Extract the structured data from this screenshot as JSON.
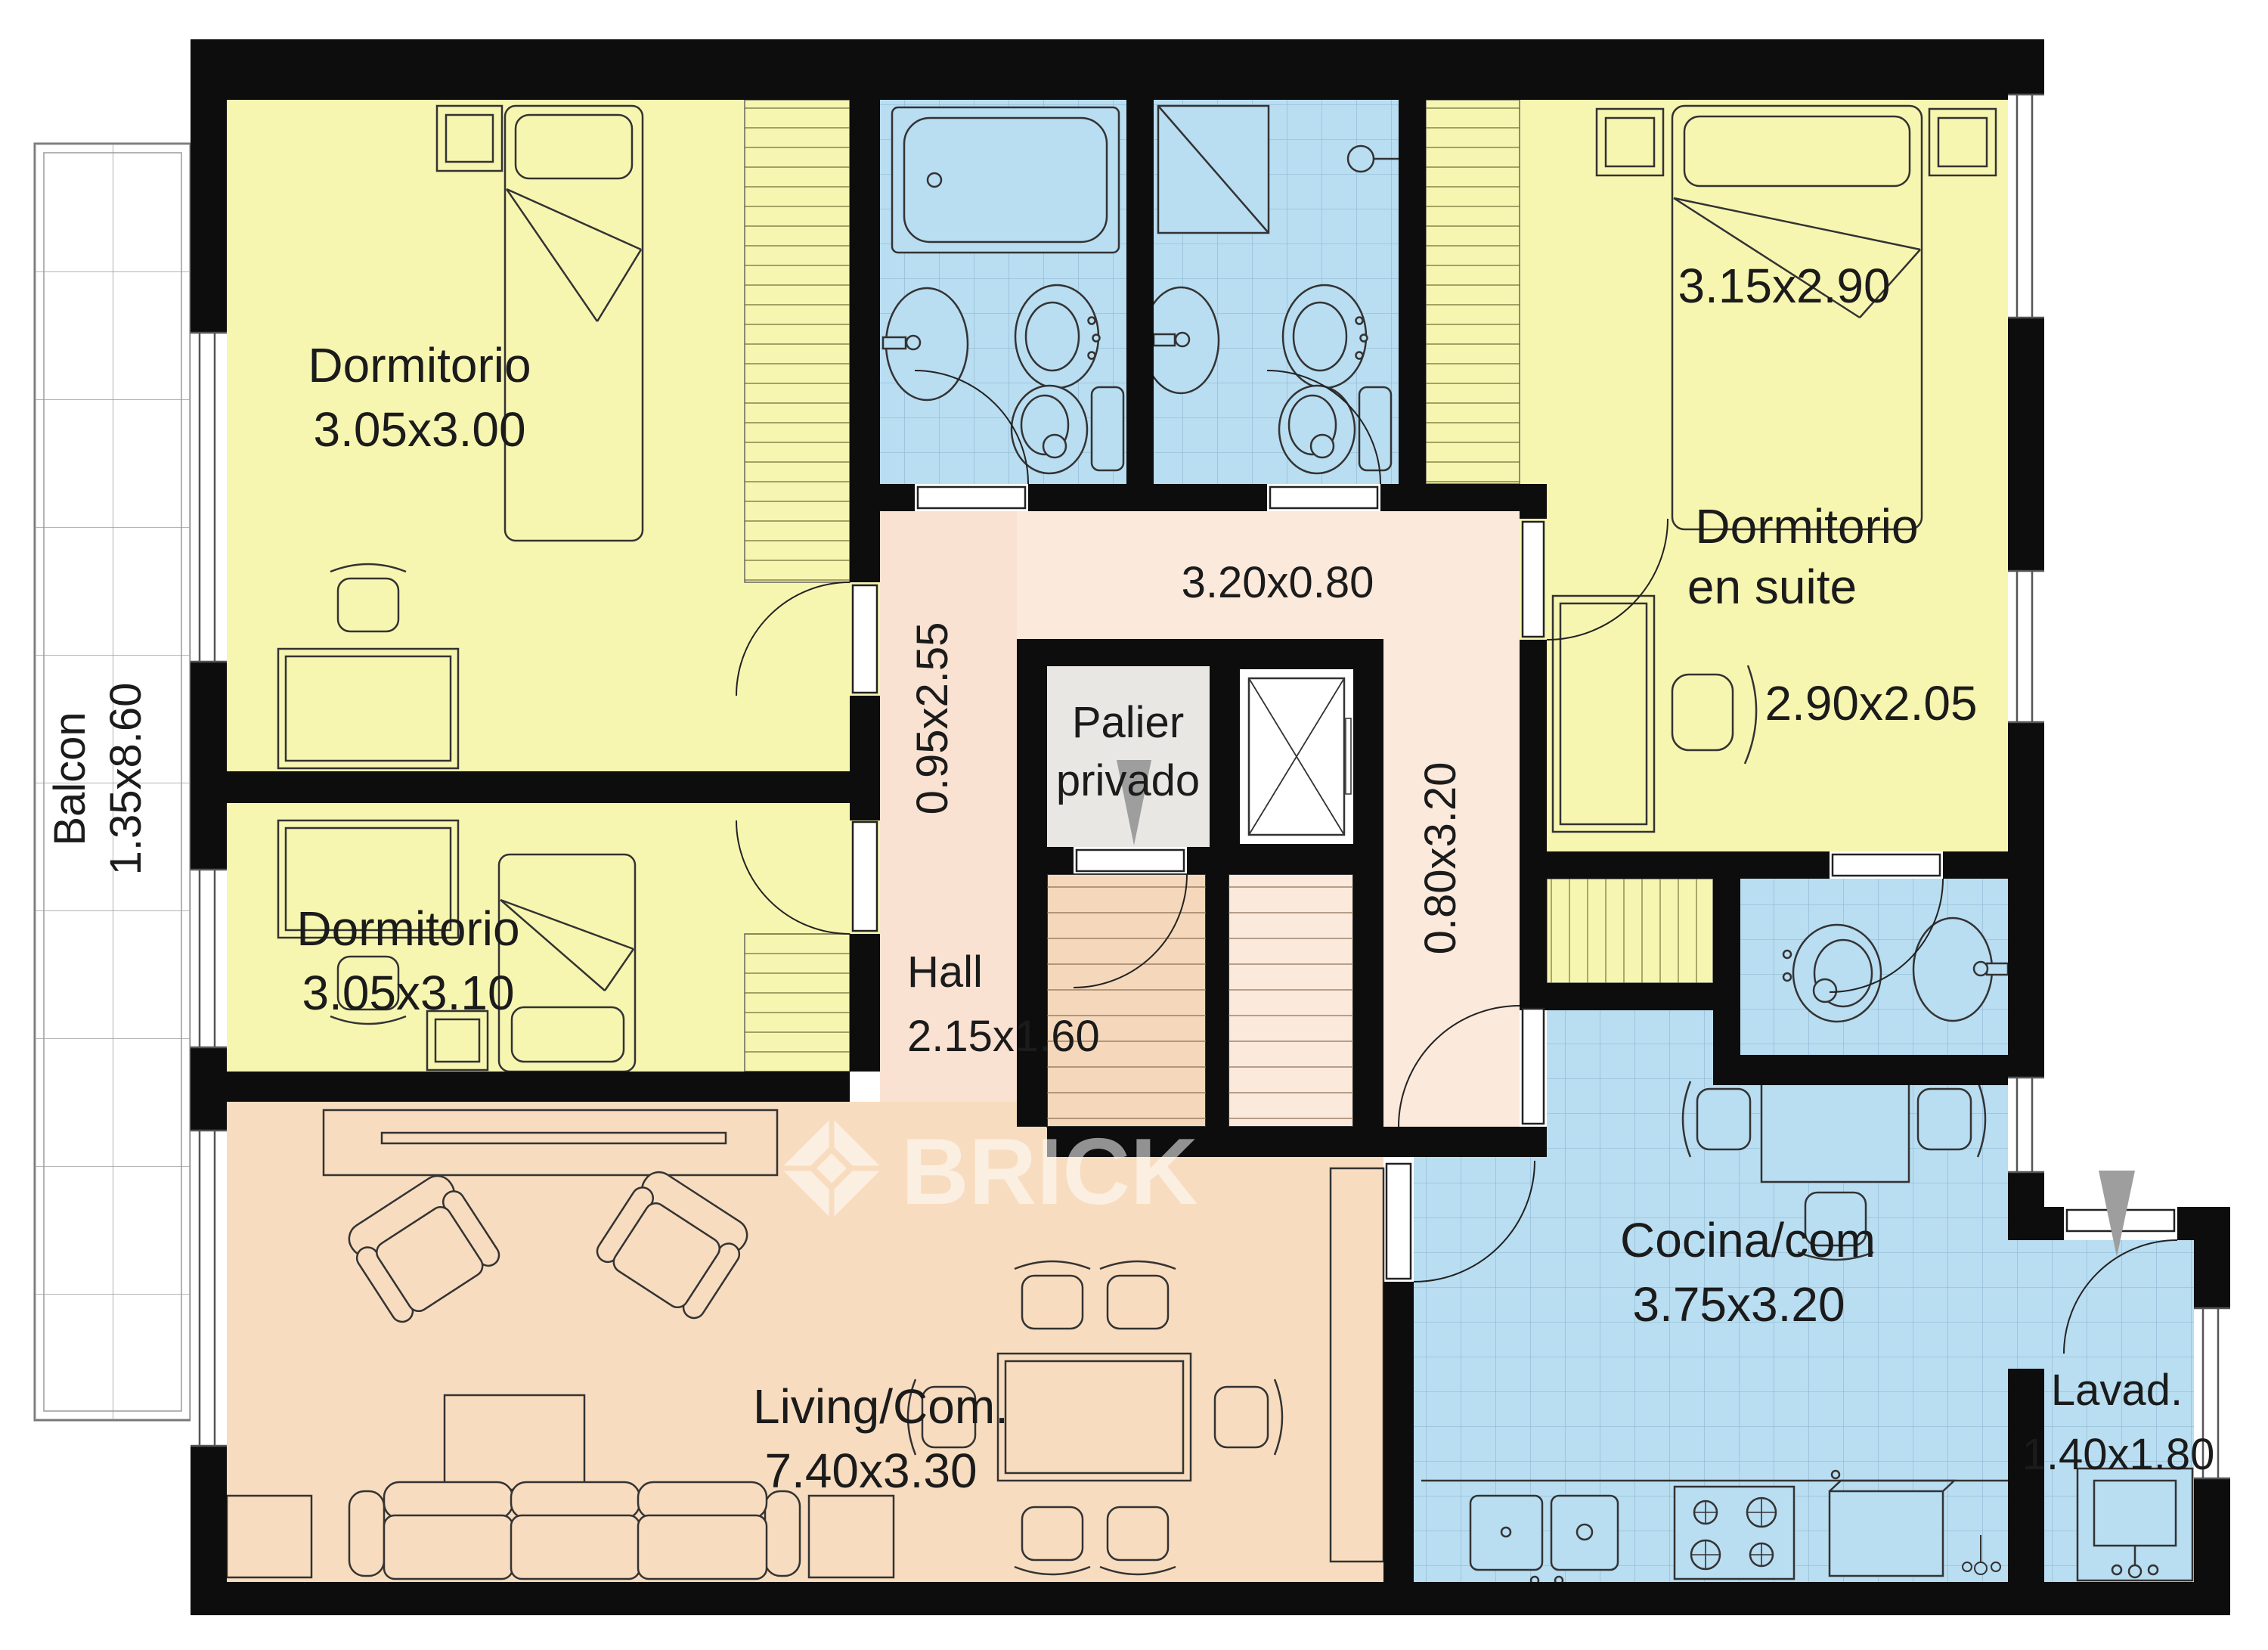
{
  "plan_title": "Apartment floor plan",
  "watermark": {
    "text": "BRICK"
  },
  "rooms": {
    "balcony": {
      "name": "Balcon",
      "dims": "1.35x8.60"
    },
    "bedroom1": {
      "name": "Dormitorio",
      "dims": "3.05x3.00"
    },
    "bedroom2": {
      "name": "Dormitorio",
      "dims": "3.05x3.10"
    },
    "suite": {
      "line1": "Dormitorio",
      "line2": "en suite",
      "bed_dims": "3.15x2.90",
      "desk_dims": "2.90x2.05"
    },
    "palier": {
      "line1": "Palier",
      "line2": "privado"
    },
    "hall": {
      "name": "Hall",
      "dims": "2.15x1.60"
    },
    "living": {
      "name": "Living/Com.",
      "dims": "7.40x3.30"
    },
    "kitchen": {
      "name": "Cocina/com",
      "dims": "3.75x3.20"
    },
    "laundry": {
      "name": "Lavad.",
      "dims": "1.40x1.80"
    }
  },
  "corridors": {
    "bath_corridor": "3.20x0.80",
    "bedroom_corridor": "0.95x2.55",
    "kitchen_corridor": "0.80x3.20"
  },
  "colors": {
    "wall": "#0d0d0d",
    "bedroom_yellow": "#f7f6b1",
    "wet_blue": "#b9ddf1",
    "tile_line": "#6f9cba",
    "living_salmon": "#f8dcbf",
    "hall_pink": "#f9e2d2",
    "corridor_pink": "#fbe9dc",
    "palier_gray": "#e9e7e4",
    "stair_a": "#f5d8bc",
    "stair_b": "#fbe9dc",
    "entry_arrow_gray": "#9e9e9e"
  }
}
